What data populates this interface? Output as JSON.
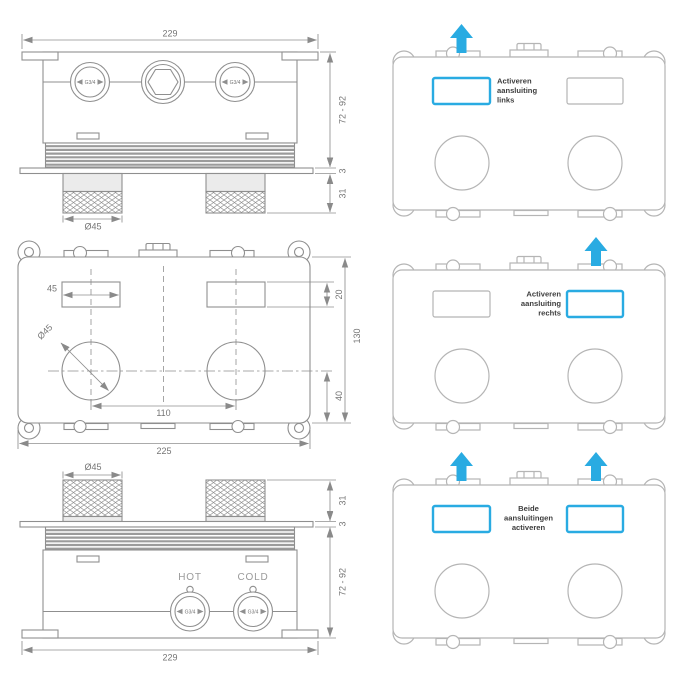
{
  "colors": {
    "accent": "#29abe2",
    "line": "#8f8f8f",
    "line_light": "#b5b5b5",
    "dim_text": "#757575",
    "caption_text": "#3d3d3d"
  },
  "panels": {
    "top_left": {
      "width_label": "229",
      "depth_label": "72 - 92",
      "plate_label": "3",
      "knob_height_label": "31",
      "knob_diameter_label": "Ø45",
      "port_left_label": "G3/4",
      "port_right_label": "G3/4"
    },
    "middle_left": {
      "rect_width_label": "45",
      "rect_height_label": "20",
      "height_label": "130",
      "center_offset_label": "40",
      "port_spacing_label": "110",
      "width_label": "225",
      "circle_diameter_label": "Ø45"
    },
    "bottom_left": {
      "knob_diameter_label": "Ø45",
      "knob_height_label": "31",
      "plate_label": "3",
      "depth_label": "72 - 92",
      "hot_label": "HOT",
      "cold_label": "COLD",
      "port_hot_label": "G3/4",
      "port_cold_label": "G3/4",
      "width_label": "229"
    },
    "top_right": {
      "caption_lines": [
        "Activeren",
        "aansluiting",
        "links"
      ]
    },
    "middle_right": {
      "caption_lines": [
        "Activeren",
        "aansluiting",
        "rechts"
      ]
    },
    "bottom_right": {
      "caption_lines": [
        "Beide",
        "aansluitingen",
        "activeren"
      ]
    }
  }
}
